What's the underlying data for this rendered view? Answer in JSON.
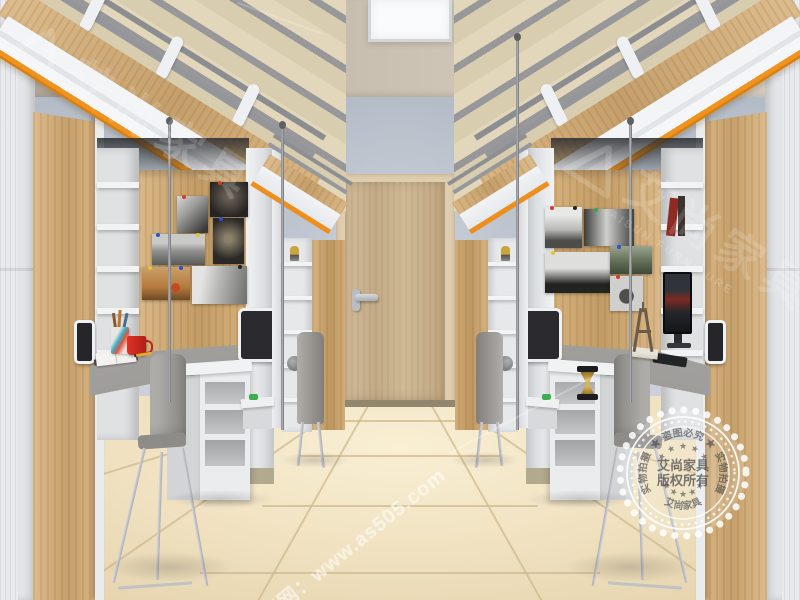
{
  "scene": {
    "description": "3D render of a student dormitory room: mirrored loft-bed units (bed above, desk/shelves below) in light oak and white with orange trim, grey chairs, wood door on grey-blue wall, cream tile floor"
  },
  "watermarks": {
    "brand_cn": "艾尚家具",
    "brand_en": "AISUN FURNITURE",
    "site_label": "官网：www.as505.com",
    "stamp": {
      "arc_top": "★ 盗图必究 ★",
      "arc_left": "实物拍摄",
      "arc_right": "实物拍摄",
      "arc_bottom": "艾尚家具",
      "stars_top": "★ ★ ★ ★ ★",
      "stars_bottom": "★ ★ ★ ★ ★",
      "center_line1": "艾尚家具",
      "center_line2": "版权所有"
    }
  },
  "palette": {
    "wall": "#bcc3cf",
    "ceiling": "#ccc3b5",
    "floor": "#f1e3c2",
    "module_wood": "#d5ad74",
    "door_wood": "#c9b28e",
    "accent_orange": "#f0921e",
    "frame_white": "#eef0f2",
    "desk_gray": "#9b9a97",
    "chair_gray": "#8f8d89",
    "mug_red": "#d02a1e",
    "watermark_white": "#ffffff"
  }
}
